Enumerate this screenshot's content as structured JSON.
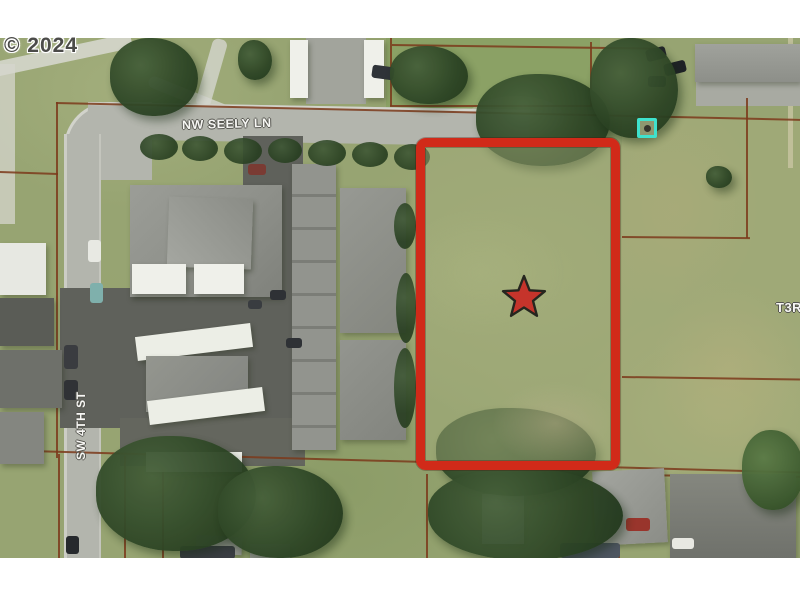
{
  "map": {
    "copyright": "© 2024",
    "labels": {
      "street_h": "NW SEELY LN",
      "street_v": "SW 4TH ST",
      "township": "T3R"
    },
    "colors": {
      "parcel_highlight": "#d12a19",
      "star_fill": "#c5342b",
      "star_outline": "#26261f",
      "poi_marker": "#3fe2cd",
      "lot_line": "#7b3a1b",
      "road": "#b3b5ad",
      "asphalt": "#5f615b",
      "grass": "#97a472",
      "tree": "#2c4424",
      "roof_white": "#eff0ea",
      "roof_gray": "#8e908a",
      "label_text": "#f7f7f4",
      "copyright_text": "#4b4b49"
    }
  }
}
